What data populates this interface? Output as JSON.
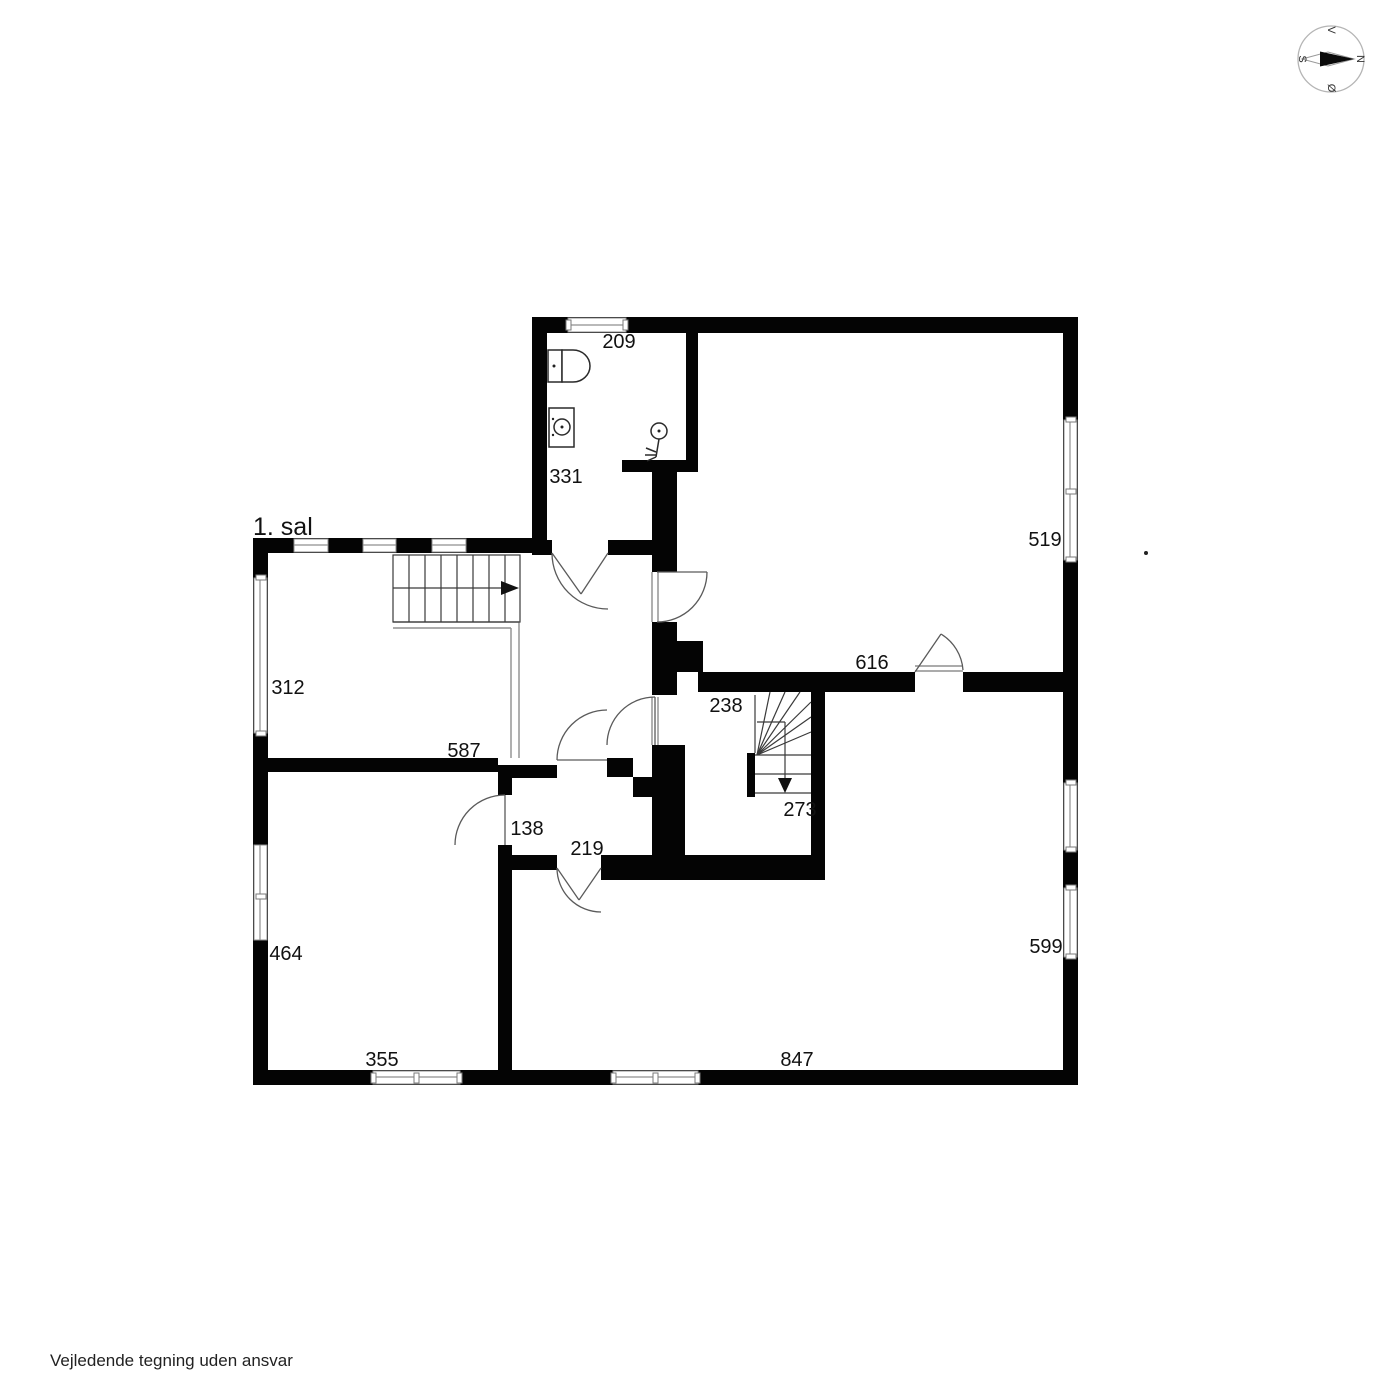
{
  "page": {
    "title": "1. sal",
    "disclaimer": "Vejledende tegning uden ansvar"
  },
  "compass": {
    "north": "N",
    "south": "S",
    "east": "Ø",
    "west": "V"
  },
  "dimensions": {
    "bathroom_width": "209",
    "bathroom_depth": "331",
    "upper_right_room_window": "519",
    "upper_right_room_width": "616",
    "upper_left_room_window": "312",
    "upper_left_room_wall": "587",
    "hallway_width": "238",
    "winder_stair_width": "273",
    "inner_room_width": "138",
    "inner_room_door": "219",
    "lower_left_room_window": "464",
    "lower_left_room_bottom": "355",
    "lower_right_room_window": "599",
    "lower_right_room_width": "847"
  }
}
